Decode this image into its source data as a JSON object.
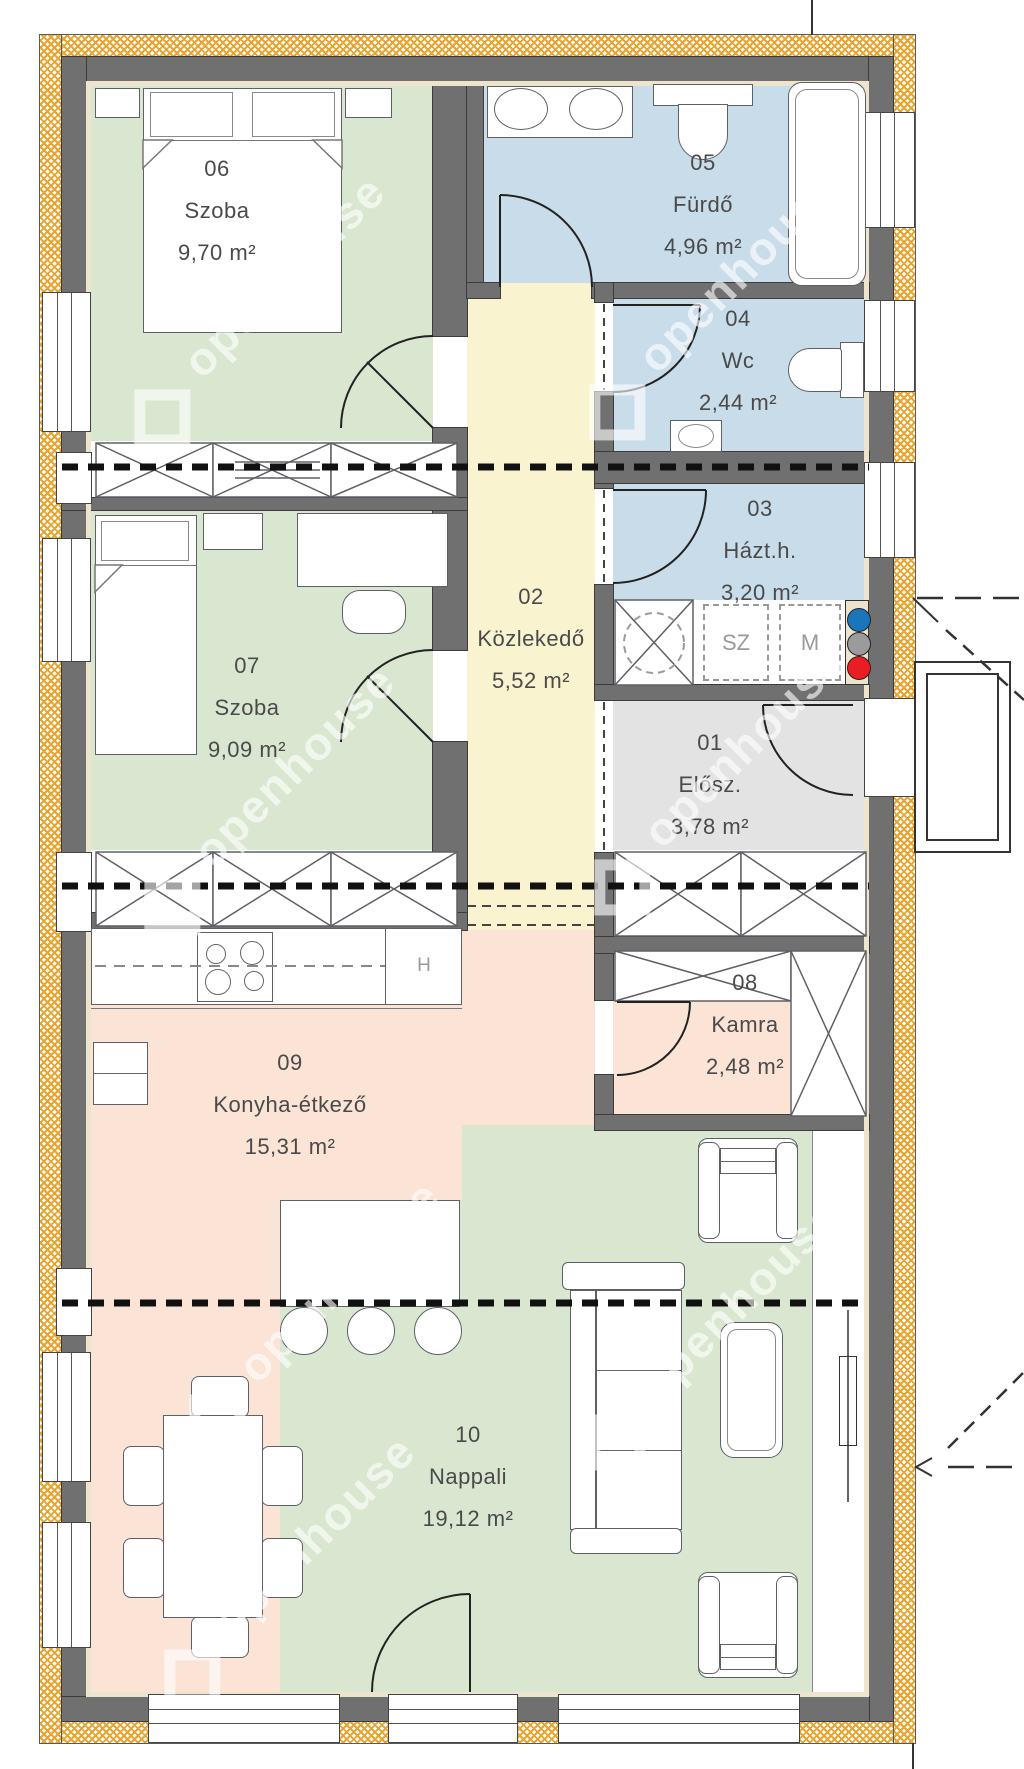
{
  "plan": {
    "watermark": "openhouse",
    "rooms": [
      {
        "num": "01",
        "name": "Elősz.",
        "area": "3,78 m²"
      },
      {
        "num": "02",
        "name": "Közlekedő",
        "area": "5,52 m²"
      },
      {
        "num": "03",
        "name": "Házt.h.",
        "area": "3,20 m²"
      },
      {
        "num": "04",
        "name": "Wc",
        "area": "2,44 m²"
      },
      {
        "num": "05",
        "name": "Fürdő",
        "area": "4,96 m²"
      },
      {
        "num": "06",
        "name": "Szoba",
        "area": "9,70 m²"
      },
      {
        "num": "07",
        "name": "Szoba",
        "area": "9,09 m²"
      },
      {
        "num": "08",
        "name": "Kamra",
        "area": "2,48 m²"
      },
      {
        "num": "09",
        "name": "Konyha-étkező",
        "area": "15,31 m²"
      },
      {
        "num": "10",
        "name": "Nappali",
        "area": "19,12 m²"
      }
    ],
    "appliance_labels": {
      "water_heater": "HMW",
      "dryer": "SZ",
      "washer": "M",
      "fridge": "H"
    },
    "utility_dot_colors": {
      "blue": "#1b75bb",
      "gray": "#9b9b9b",
      "red": "#ec1c24"
    },
    "palette": {
      "bedroom_green": "#d9e7d0",
      "bath_blue": "#c8dce9",
      "corridor_yellow": "#faf3d0",
      "hall_gray": "#e3e3e3",
      "kitchen_salmon": "#fbe3d5",
      "wall_gray": "#707070",
      "hatch_orange": "#e7a430"
    }
  }
}
